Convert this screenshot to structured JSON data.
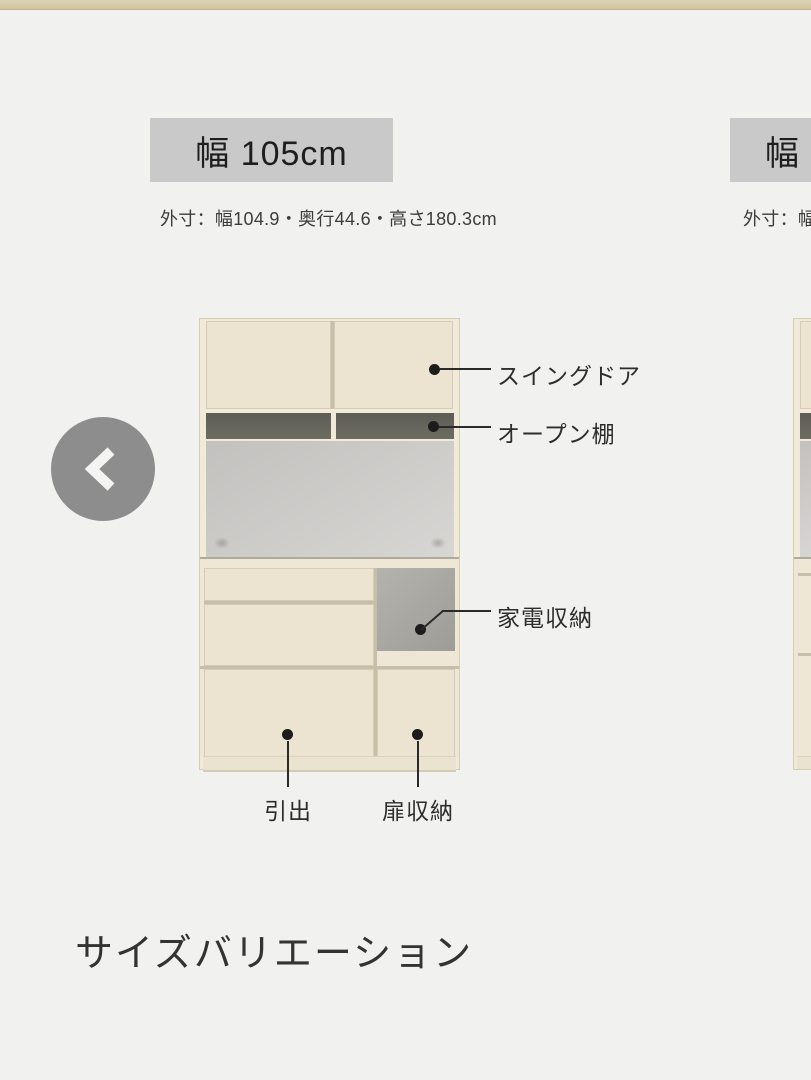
{
  "page": {
    "section_heading": "サイズバリエーション"
  },
  "carousel": {
    "prev_button_label": "previous",
    "items": [
      {
        "title": "幅 105cm",
        "dimensions": "外寸：幅104.9・奥行44.6・高さ180.3cm",
        "callouts": {
          "swing_door": "スイングドア",
          "open_shelf": "オープン棚",
          "appliance_storage": "家電収納",
          "drawer": "引出",
          "door_storage": "扉収納"
        }
      },
      {
        "title": "幅",
        "dimensions": "外寸：幅"
      }
    ]
  },
  "colors": {
    "top_bar": "#d7cdab",
    "title_box_bg": "#c9c9c9",
    "cabinet_front": "#ece4d1",
    "cabinet_frame": "#f1ead9",
    "open_shelf_dark": "#67665e",
    "back_panel_gray": "#cbcac7",
    "appliance_nook_gray": "#aba9a3",
    "callout_ink": "#222222",
    "nav_circle_gray": "#8d8d8d",
    "page_background": "#f1f1f0"
  }
}
